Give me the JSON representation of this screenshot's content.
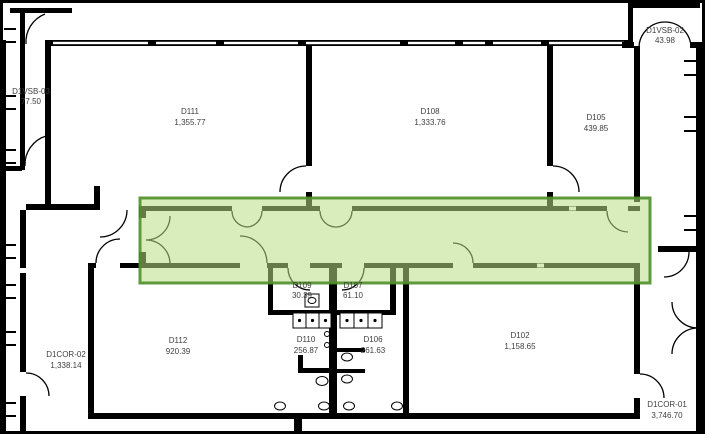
{
  "plan": {
    "type": "architectural floor plan",
    "rooms": [
      {
        "id": "d1vsb-03",
        "name": "D1VSB-03",
        "area": "77.50"
      },
      {
        "id": "d111",
        "name": "D111",
        "area": "1,355.77"
      },
      {
        "id": "d108",
        "name": "D108",
        "area": "1,333.76"
      },
      {
        "id": "d105",
        "name": "D105",
        "area": "439.85"
      },
      {
        "id": "d1vsb-02",
        "name": "D1VSB-02",
        "area": "43.98"
      },
      {
        "id": "d109",
        "name": "D109",
        "area": "30.39"
      },
      {
        "id": "d107",
        "name": "D107",
        "area": "61.10"
      },
      {
        "id": "d112",
        "name": "D112",
        "area": "920.39"
      },
      {
        "id": "d110",
        "name": "D110",
        "area": "256.87"
      },
      {
        "id": "d106",
        "name": "D106",
        "area": "261.63"
      },
      {
        "id": "d102",
        "name": "D102",
        "area": "1,158.65"
      },
      {
        "id": "d1cor-02",
        "name": "D1COR-02",
        "area": "1,338.14"
      },
      {
        "id": "d1cor-01",
        "name": "D1COR-01",
        "area": "3,746.70"
      }
    ],
    "highlight": {
      "target": "main-corridor",
      "fill": "#b9dd85",
      "stroke": "#4f8f2a"
    }
  },
  "colors": {
    "wall": "#000000",
    "background": "#ffffff",
    "label_text": "#3f3f3f",
    "highlight_fill": "#b9dd85",
    "highlight_stroke": "#4f8f2a"
  }
}
